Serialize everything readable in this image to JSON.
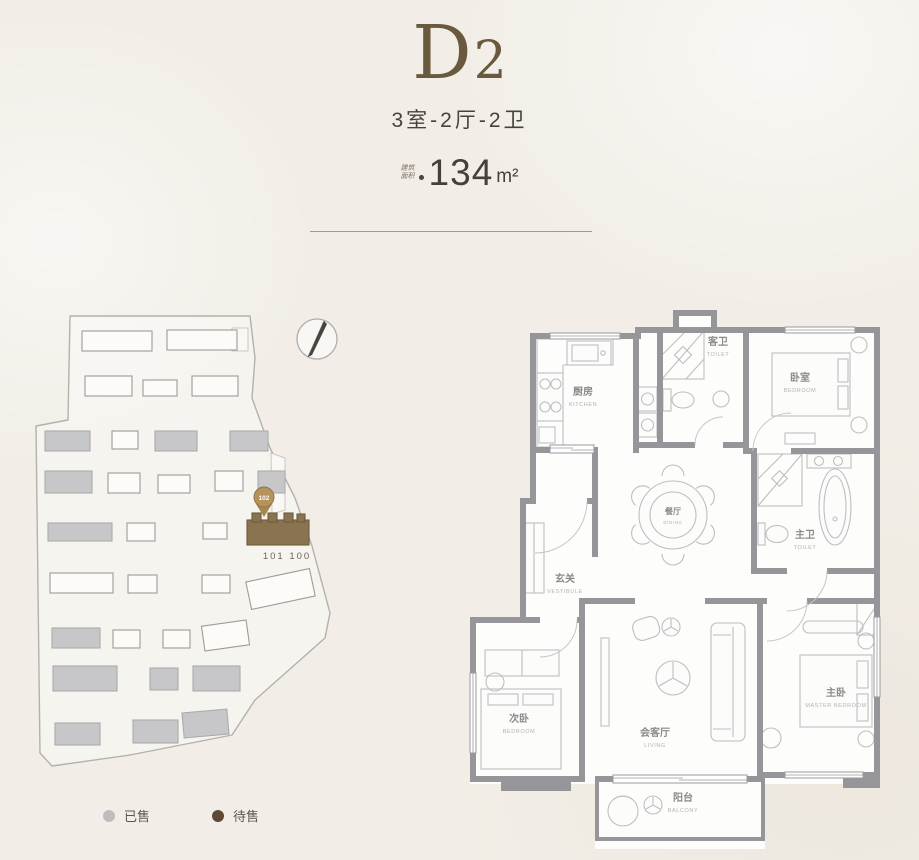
{
  "header": {
    "unit_name": "D",
    "unit_sub": "2",
    "layout": "3室-2厅-2卫",
    "area_label_line1": "建筑",
    "area_label_line2": "面积",
    "area_value": "134",
    "area_unit": "m²"
  },
  "site_plan": {
    "marker_label": "102",
    "unit_numbers": "101 100",
    "buildings": [
      {
        "x": 57,
        "y": 28,
        "w": 70,
        "h": 20,
        "status": "forsale"
      },
      {
        "x": 142,
        "y": 27,
        "w": 70,
        "h": 20,
        "status": "forsale"
      },
      {
        "x": 60,
        "y": 73,
        "w": 47,
        "h": 20,
        "status": "forsale"
      },
      {
        "x": 118,
        "y": 77,
        "w": 34,
        "h": 16,
        "status": "forsale"
      },
      {
        "x": 167,
        "y": 73,
        "w": 46,
        "h": 20,
        "status": "forsale"
      },
      {
        "x": 20,
        "y": 128,
        "w": 45,
        "h": 20,
        "status": "sold"
      },
      {
        "x": 87,
        "y": 128,
        "w": 26,
        "h": 18,
        "status": "forsale"
      },
      {
        "x": 130,
        "y": 128,
        "w": 42,
        "h": 20,
        "status": "sold"
      },
      {
        "x": 205,
        "y": 128,
        "w": 38,
        "h": 20,
        "status": "sold"
      },
      {
        "x": 20,
        "y": 168,
        "w": 47,
        "h": 22,
        "status": "sold"
      },
      {
        "x": 83,
        "y": 170,
        "w": 32,
        "h": 20,
        "status": "forsale"
      },
      {
        "x": 133,
        "y": 172,
        "w": 32,
        "h": 18,
        "status": "forsale"
      },
      {
        "x": 190,
        "y": 168,
        "w": 28,
        "h": 20,
        "status": "forsale"
      },
      {
        "x": 233,
        "y": 168,
        "w": 27,
        "h": 22,
        "status": "sold"
      },
      {
        "x": 23,
        "y": 220,
        "w": 64,
        "h": 18,
        "status": "sold"
      },
      {
        "x": 102,
        "y": 220,
        "w": 28,
        "h": 18,
        "status": "forsale"
      },
      {
        "x": 178,
        "y": 220,
        "w": 24,
        "h": 16,
        "status": "forsale"
      },
      {
        "x": 222,
        "y": 217,
        "w": 62,
        "h": 25,
        "status": "highlight"
      },
      {
        "x": 25,
        "y": 270,
        "w": 63,
        "h": 20,
        "status": "forsale"
      },
      {
        "x": 103,
        "y": 272,
        "w": 29,
        "h": 18,
        "status": "forsale"
      },
      {
        "x": 177,
        "y": 272,
        "w": 28,
        "h": 18,
        "status": "forsale"
      },
      {
        "x": 223,
        "y": 272,
        "w": 65,
        "h": 28,
        "status": "forsale",
        "r": -12
      },
      {
        "x": 27,
        "y": 325,
        "w": 48,
        "h": 20,
        "status": "sold"
      },
      {
        "x": 88,
        "y": 327,
        "w": 27,
        "h": 18,
        "status": "forsale"
      },
      {
        "x": 138,
        "y": 327,
        "w": 27,
        "h": 18,
        "status": "forsale"
      },
      {
        "x": 178,
        "y": 320,
        "w": 45,
        "h": 25,
        "status": "forsale",
        "r": -8
      },
      {
        "x": 28,
        "y": 363,
        "w": 64,
        "h": 25,
        "status": "sold"
      },
      {
        "x": 125,
        "y": 365,
        "w": 28,
        "h": 22,
        "status": "sold"
      },
      {
        "x": 168,
        "y": 363,
        "w": 47,
        "h": 25,
        "status": "sold"
      },
      {
        "x": 30,
        "y": 420,
        "w": 45,
        "h": 22,
        "status": "sold"
      },
      {
        "x": 108,
        "y": 417,
        "w": 45,
        "h": 23,
        "status": "sold"
      },
      {
        "x": 158,
        "y": 408,
        "w": 45,
        "h": 25,
        "status": "sold",
        "r": -5
      }
    ]
  },
  "legend": {
    "items": [
      {
        "label": "已售",
        "color": "#bdbdbd"
      },
      {
        "label": "待售",
        "color": "#5c4936"
      }
    ]
  },
  "floor_plan": {
    "rooms": [
      {
        "id": "kitchen",
        "cn": "厨房",
        "en": "KITCHEN"
      },
      {
        "id": "guest-toilet",
        "cn": "客卫",
        "en": "TOILET"
      },
      {
        "id": "bedroom-top",
        "cn": "卧室",
        "en": "BEDROOM"
      },
      {
        "id": "vestibule",
        "cn": "玄关",
        "en": "VESTIBULE"
      },
      {
        "id": "dining",
        "cn": "餐厅",
        "en": "DINING"
      },
      {
        "id": "master-toilet",
        "cn": "主卫",
        "en": "TOILET"
      },
      {
        "id": "bedroom-second",
        "cn": "次卧",
        "en": "BEDROOM"
      },
      {
        "id": "living",
        "cn": "会客厅",
        "en": "LIVING"
      },
      {
        "id": "master-bedroom",
        "cn": "主卧",
        "en": "MASTER BEDROOM"
      },
      {
        "id": "balcony",
        "cn": "阳台",
        "en": "BALCONY"
      }
    ]
  }
}
